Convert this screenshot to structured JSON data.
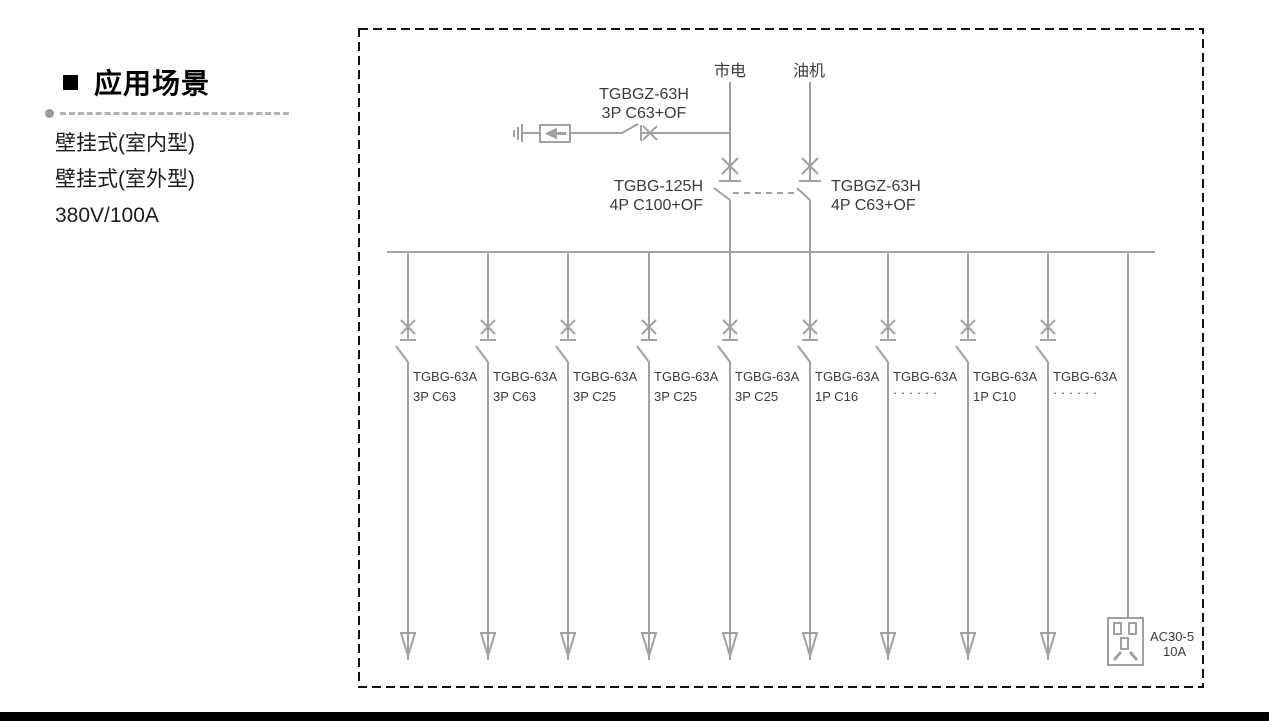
{
  "panel": {
    "heading": "应用场景",
    "items": [
      "壁挂式(室内型)",
      "壁挂式(室外型)",
      "380V/100A"
    ]
  },
  "diagram": {
    "source_mains": "市电",
    "source_generator": "油机",
    "spd_breaker": {
      "model": "TGBGZ-63H",
      "spec": "3P C63+OF"
    },
    "main_breaker_mains": {
      "model": "TGBG-125H",
      "spec": "4P C100+OF"
    },
    "main_breaker_generator": {
      "model": "TGBGZ-63H",
      "spec": "4P C63+OF"
    },
    "branches": [
      {
        "model": "TGBG-63A",
        "spec": "3P C63"
      },
      {
        "model": "TGBG-63A",
        "spec": "3P C63"
      },
      {
        "model": "TGBG-63A",
        "spec": "3P C25"
      },
      {
        "model": "TGBG-63A",
        "spec": "3P C25"
      },
      {
        "model": "TGBG-63A",
        "spec": "3P C25"
      },
      {
        "model": "TGBG-63A",
        "spec": "1P C16"
      },
      {
        "model": "TGBG-63A",
        "spec": "· · · · · ·"
      },
      {
        "model": "TGBG-63A",
        "spec": "1P C10"
      },
      {
        "model": "TGBG-63A",
        "spec": "· · · · · ·"
      }
    ],
    "socket": {
      "model": "AC30-5",
      "rating": "10A"
    }
  },
  "colors": {
    "wire": "#a1a1a1",
    "diagram_text": "#3b3b3b",
    "border": "#111111",
    "bottom_bar": "#000000"
  }
}
